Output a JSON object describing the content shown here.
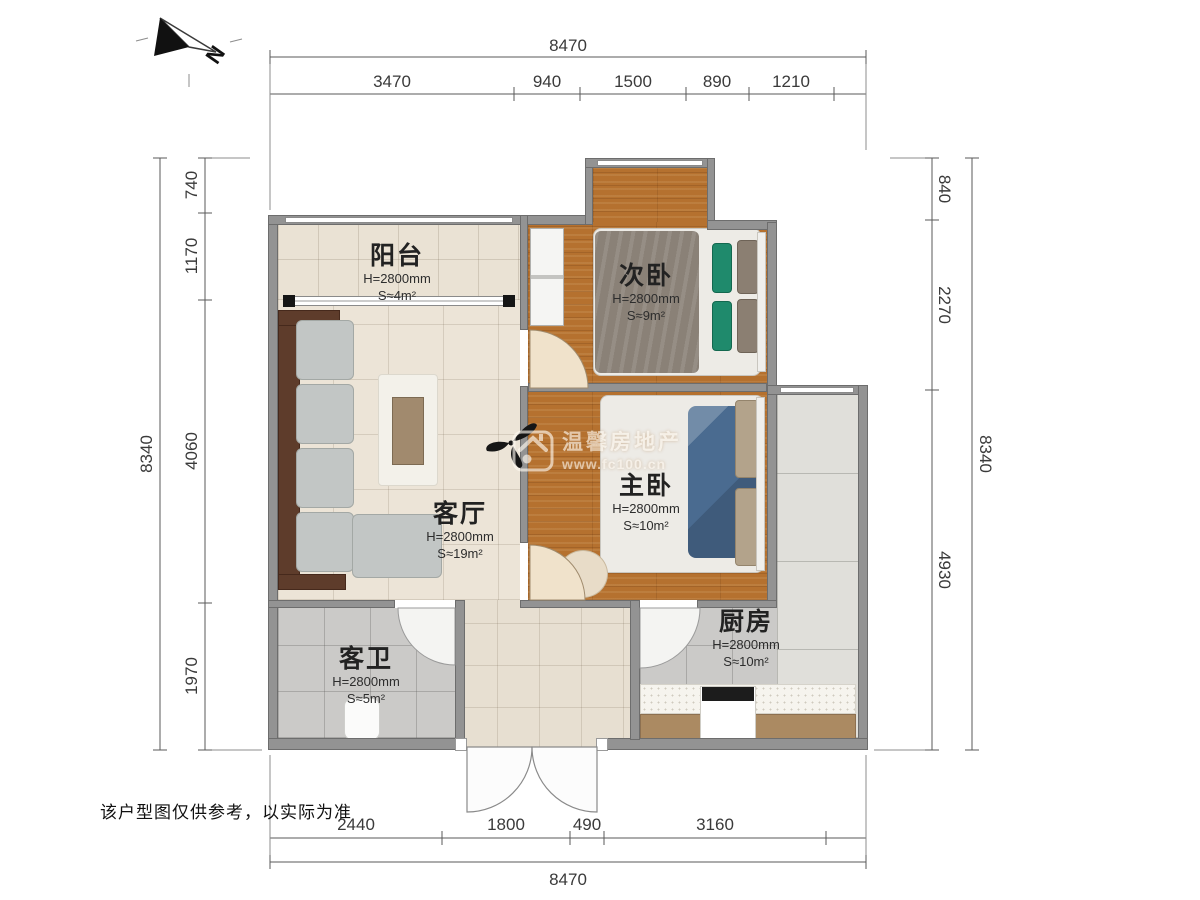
{
  "note": "该户型图仅供参考，以实际为准",
  "compass": {
    "label": "N"
  },
  "watermark": {
    "brand": "温馨房地产",
    "url": "www.fc100.cn"
  },
  "dims": {
    "top": {
      "total": "8470",
      "segments": [
        "3470",
        "940",
        "1500",
        "890",
        "1210"
      ]
    },
    "bottom": {
      "total": "8470",
      "segments": [
        "2440",
        "1800",
        "490",
        "3160"
      ]
    },
    "left": {
      "total": "8340",
      "segments": [
        "740",
        "1170",
        "4060",
        "1970"
      ]
    },
    "right": {
      "total": "8340",
      "segments": [
        "840",
        "2270",
        "4930"
      ]
    }
  },
  "rooms": [
    {
      "name": "阳台",
      "height": "H=2800mm",
      "area": "S≈4m²"
    },
    {
      "name": "次卧",
      "height": "H=2800mm",
      "area": "S≈9m²"
    },
    {
      "name": "客厅",
      "height": "H=2800mm",
      "area": "S≈19m²"
    },
    {
      "name": "主卧",
      "height": "H=2800mm",
      "area": "S≈10m²"
    },
    {
      "name": "客卫",
      "height": "H=2800mm",
      "area": "S≈5m²"
    },
    {
      "name": "厨房",
      "height": "H=2800mm",
      "area": "S≈10m²"
    }
  ],
  "colors": {
    "wall": "#939393",
    "wood_floor": "#b5712f",
    "tile_beige": "#eae2d4",
    "tile_gray": "#cbcac8",
    "pillow_green": "#1f8a6c",
    "clothes_blue": "#4a6b90"
  }
}
